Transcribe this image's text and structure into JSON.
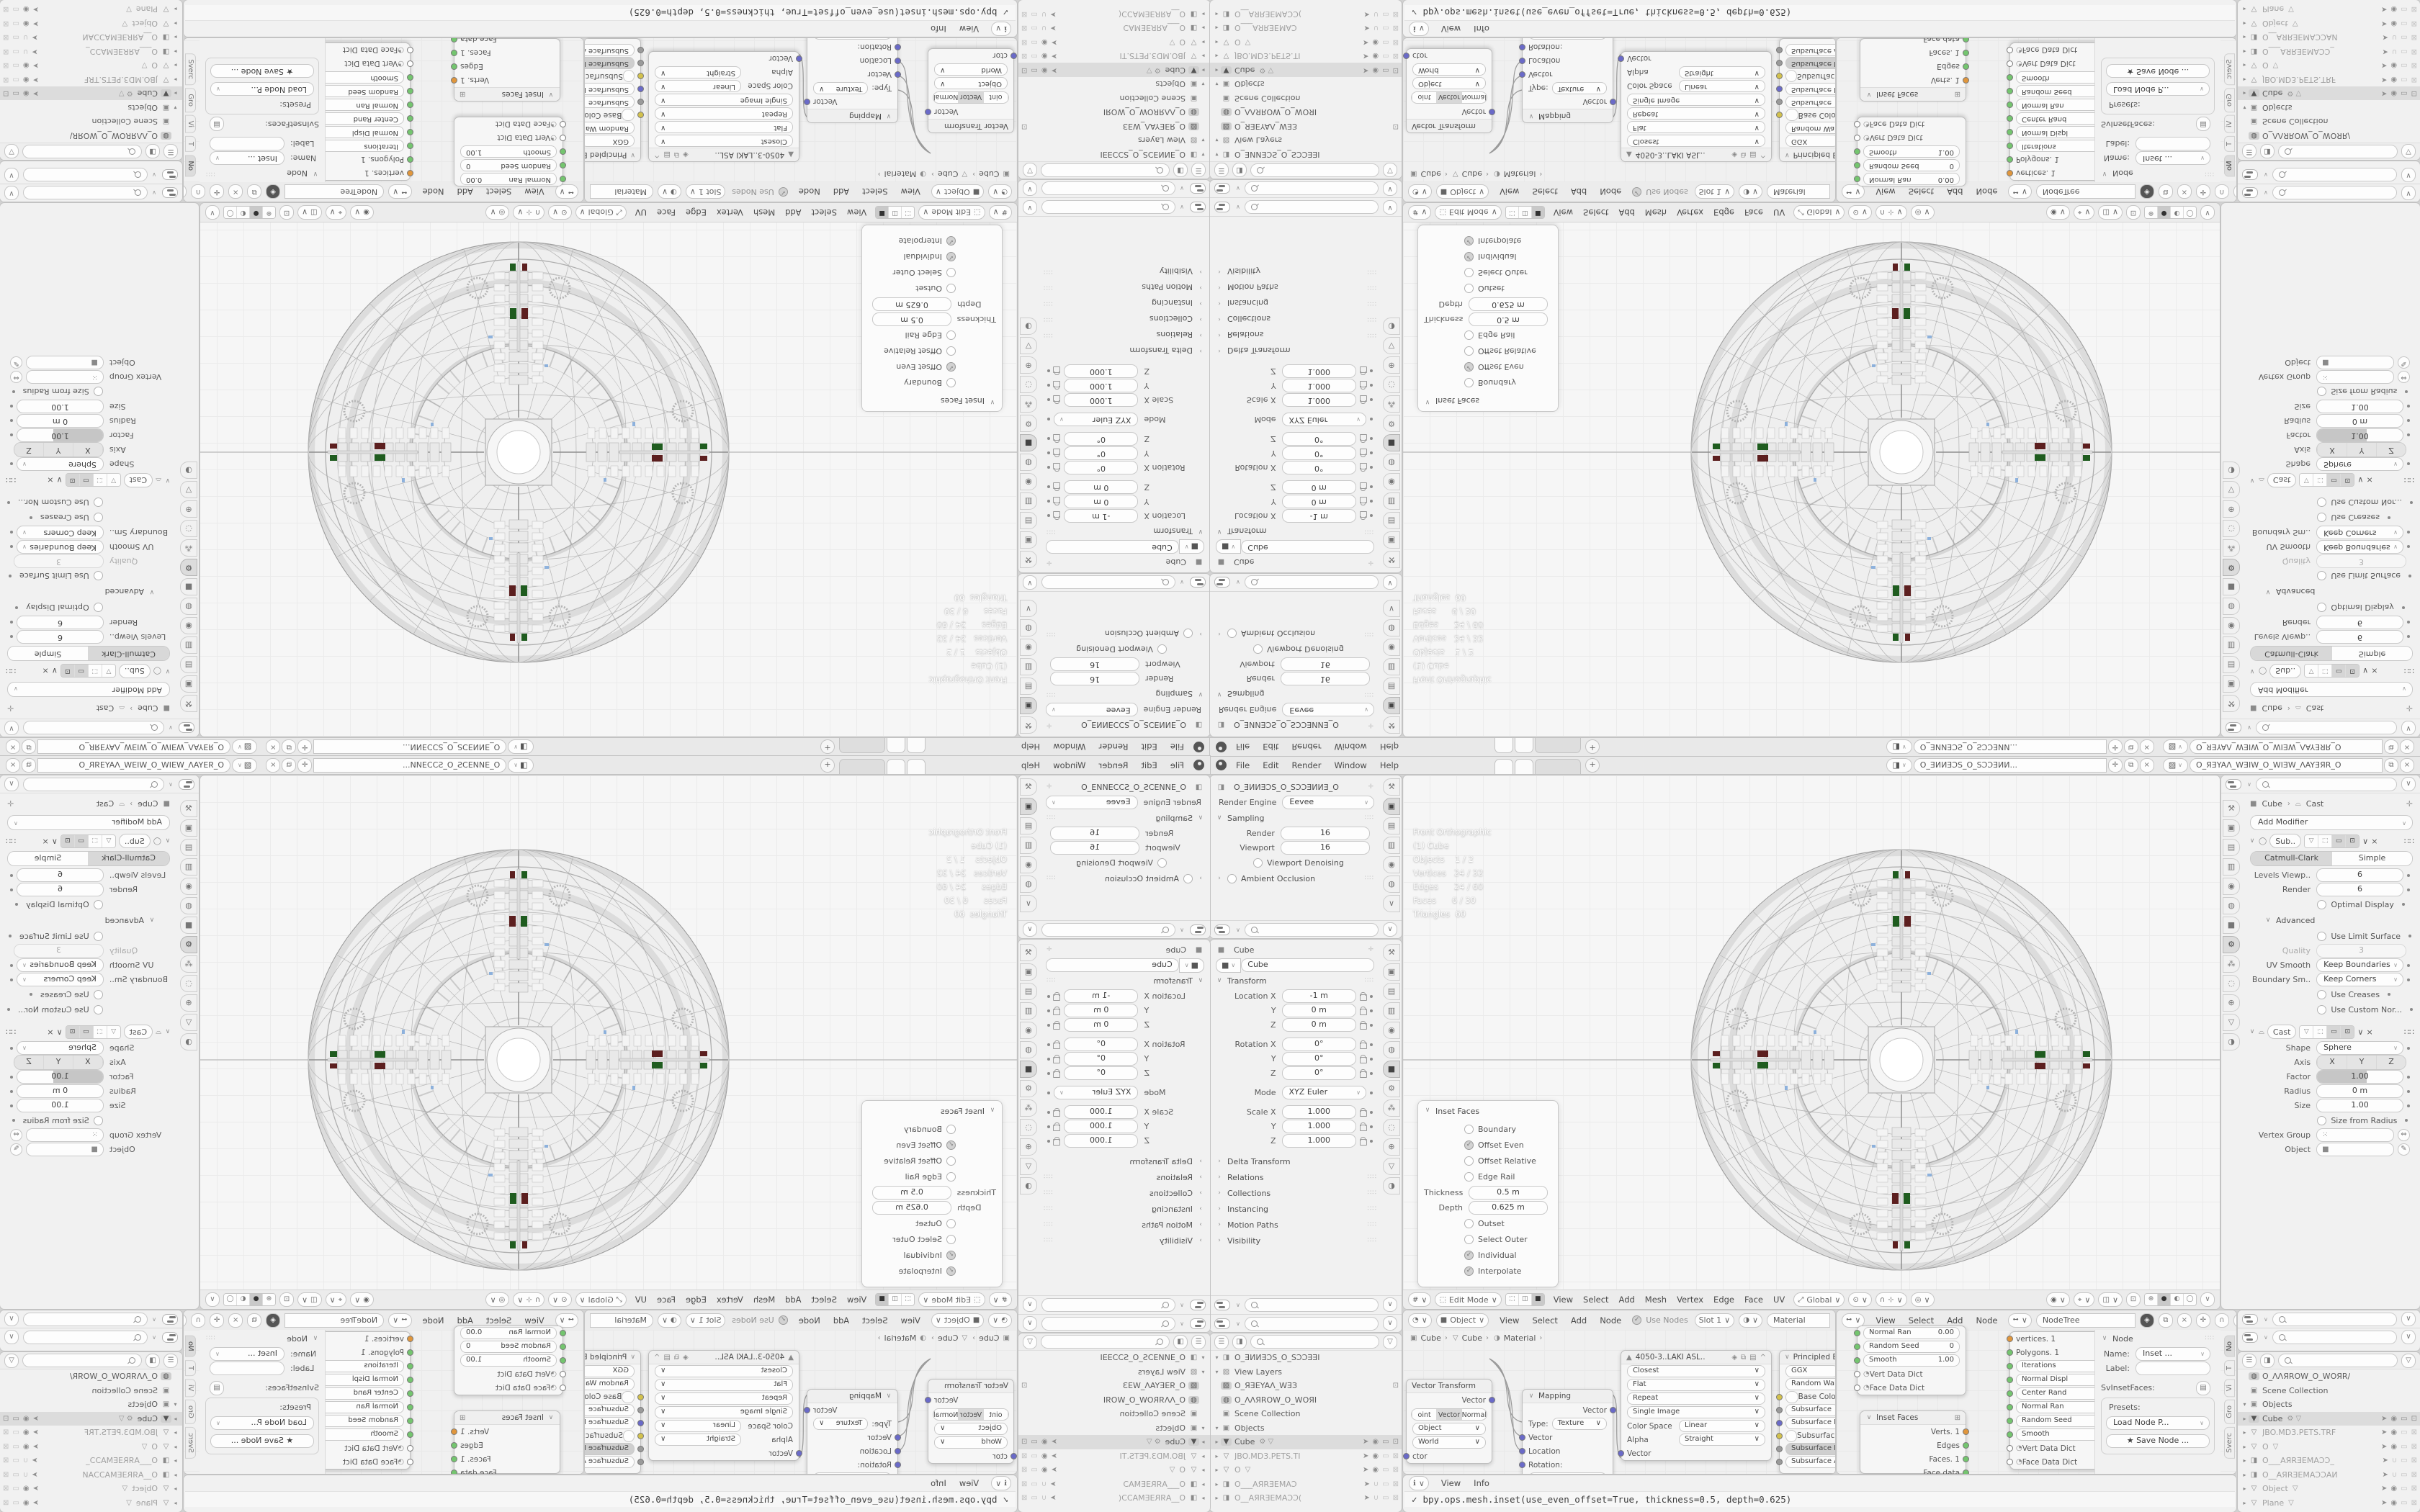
{
  "topbar": {
    "menus": [
      "File",
      "Edit",
      "Render",
      "Window",
      "Help"
    ],
    "plus": "+",
    "scene": {
      "value": "O_ƎИИƎƆS_O_SƆƆƎИИ..."
    },
    "view_layer": {
      "value": "O_ЯƎYAΛ_WƎIW_O_WIƎW_ΛAYƎЯR_O"
    }
  },
  "render_props": {
    "scene_name": "O_ƎИИƎƆS_O_SƆƆƎИИƎ_O",
    "engine_label": "Render Engine",
    "engine": "Eevee",
    "sampling_title": "Sampling",
    "rows": [
      {
        "label": "Render",
        "value": "16"
      },
      {
        "label": "Viewport",
        "value": "16"
      }
    ],
    "denoising": {
      "label": "Viewport Denoising",
      "chkcls": "chk"
    },
    "ao_label": "Ambient Occlusion"
  },
  "object_props": {
    "pin_title": "Cube",
    "name": "Cube",
    "transform_title": "Transform",
    "rows": [
      {
        "label": "Location X",
        "value": "-1 m",
        "cls": "lockdot"
      },
      {
        "label": "Y",
        "value": "0 m",
        "cls": "lockdot"
      },
      {
        "label": "Z",
        "value": "0 m",
        "cls": "lockdot"
      },
      {
        "label": "Rotation X",
        "value": "0°",
        "cls": "lockdot gap"
      },
      {
        "label": "Y",
        "value": "0°",
        "cls": "lockdot"
      },
      {
        "label": "Z",
        "value": "0°",
        "cls": "lockdot"
      },
      {
        "label": "Mode",
        "value": "XYZ Euler",
        "cls": "seldot gap"
      },
      {
        "label": "Scale X",
        "value": "1.000",
        "cls": "lockdot gap"
      },
      {
        "label": "Y",
        "value": "1.000",
        "cls": "lockdot"
      },
      {
        "label": "Z",
        "value": "1.000",
        "cls": "lockdot"
      }
    ],
    "sections": [
      {
        "label": "Delta Transform",
        "grip": ""
      },
      {
        "label": "Relations",
        "grip": "∷∷"
      },
      {
        "label": "Collections",
        "grip": "∷∷"
      },
      {
        "label": "Instancing",
        "grip": "∷∷"
      },
      {
        "label": "Motion Paths",
        "grip": "∷∷"
      },
      {
        "label": "Visibility",
        "grip": "∷∷"
      }
    ]
  },
  "outliner_left": {
    "rows": [
      {
        "disc": "▾",
        "icon": "◨",
        "name": "O_ƎИИƎƆS_O_SƆƆƎƎI",
        "ind": "i1"
      },
      {
        "disc": "▾",
        "icon": "▨",
        "name": "View Layers",
        "ind": "i2"
      },
      {
        "disc": "",
        "icon": "▨",
        "name": "O_ЯƎEYAΛ_WƎЗ",
        "ind": "i3",
        "iccls": "oic hl",
        "trailcls": "t-cam"
      },
      {
        "disc": "",
        "icon": "◍",
        "name": "O_ΛΛЯROW_O_WOЯI",
        "ind": "i2",
        "iccls": "oic hl"
      },
      {
        "disc": "",
        "icon": "▣",
        "name": "Scene Collection",
        "ind": "i2"
      },
      {
        "disc": "▾",
        "icon": "▣",
        "name": "Objects",
        "ind": "i2"
      },
      {
        "disc": "▸",
        "icon": "▼",
        "name": "Cube",
        "ind": "i3",
        "cls": "selrow",
        "iccls": "oic hl",
        "extra": "⚙ ▽",
        "trailcls": "t-full"
      },
      {
        "disc": "▸",
        "icon": "▽",
        "name": "JBO.MD3.PETS.TI",
        "ind": "i3",
        "cls": "dim",
        "trailcls": "t-std"
      },
      {
        "disc": "▸",
        "icon": "▽",
        "name": "O",
        "ind": "i3",
        "cls": "dim",
        "extra": "▽",
        "trailcls": "t-std"
      },
      {
        "disc": "▸",
        "icon": "◨",
        "name": "O___AЯRƎEMAƆ",
        "ind": "i3",
        "cls": "dim",
        "trailcls": "t-camoff"
      },
      {
        "disc": "▸",
        "icon": "◨",
        "name": "O__AЯRƎEMAƆƆ(",
        "ind": "i3",
        "cls": "dim",
        "trailcls": "t-camoff"
      }
    ]
  },
  "outliner_right": {
    "rows": [
      {
        "disc": "",
        "icon": "◍",
        "name": "O_ΛΛЯROW_O_WOЯR/",
        "ind": "i1",
        "iccls": "oic hl"
      },
      {
        "disc": "",
        "icon": "▣",
        "name": "Scene Collection",
        "ind": "i1"
      },
      {
        "disc": "▾",
        "icon": "▣",
        "name": "Objects",
        "ind": "i1"
      },
      {
        "disc": "▸",
        "icon": "▼",
        "name": "Cube",
        "ind": "i2",
        "cls": "selrow",
        "iccls": "oic hl",
        "extra": "⚙ ▽",
        "trailcls": "t-full"
      },
      {
        "disc": "▸",
        "icon": "▽",
        "name": "JBO.MD3.PETS.TRF",
        "ind": "i2",
        "cls": "dim",
        "trailcls": "t-std"
      },
      {
        "disc": "▸",
        "icon": "▽",
        "name": "O",
        "ind": "i2",
        "cls": "dim",
        "extra": "▽",
        "trailcls": "t-std"
      },
      {
        "disc": "▸",
        "icon": "◨",
        "name": "O___AЯRƎEMAƆƆ_",
        "ind": "i2",
        "cls": "dim",
        "trailcls": "t-camoff"
      },
      {
        "disc": "▸",
        "icon": "◨",
        "name": "O__AЯRƎEMAƆƆAИ",
        "ind": "i2",
        "cls": "dim",
        "trailcls": "t-camoff"
      },
      {
        "disc": "▸",
        "icon": "▽",
        "name": "Object",
        "ind": "i2",
        "cls": "dim",
        "extra": "▽",
        "trailcls": "t-std"
      },
      {
        "disc": "▸",
        "icon": "▽",
        "name": "Plane",
        "ind": "i2",
        "cls": "dim",
        "extra": "▽",
        "trailcls": "t-std"
      },
      {
        "disc": "▸",
        "icon": "▽",
        "name": "SBINEL",
        "ind": "i2",
        "cls": "dim",
        "extra": "▽",
        "trailcls": "t-std"
      }
    ]
  },
  "viewport": {
    "stats": [
      "Front Orthographic",
      "(1) Cube",
      "",
      "Objects    1 / 2",
      "Vertices   24 / 32",
      "Edges      24 / 60",
      "Faces      6 / 30",
      "Triangles  60"
    ],
    "mode": "Edit Mode",
    "menus": [
      "View",
      "Select",
      "Add",
      "Mesh",
      "Vertex",
      "Edge",
      "Face",
      "UV"
    ],
    "orientation": "Global"
  },
  "inset_panel": {
    "title": "Inset Faces",
    "checks1": [
      {
        "label": "Boundary",
        "chkcls": "chk"
      },
      {
        "label": "Offset Even",
        "chkcls": "chk on"
      },
      {
        "label": "Offset Relative",
        "chkcls": "chk"
      },
      {
        "label": "Edge Rail",
        "chkcls": "chk"
      }
    ],
    "rows": [
      {
        "label": "Thickness",
        "value": "0.5 m"
      },
      {
        "label": "Depth",
        "value": "0.625 m"
      }
    ],
    "checks2": [
      {
        "label": "Outset",
        "chkcls": "chk"
      },
      {
        "label": "Select Outer",
        "chkcls": "chk"
      },
      {
        "label": "Individual",
        "chkcls": "chk on"
      },
      {
        "label": "Interpolate",
        "chkcls": "chk on"
      }
    ]
  },
  "modifier_props": {
    "breadcrumb_object": "Cube",
    "breadcrumb_modifier": "Cast",
    "add_label": "Add Modifier",
    "subdiv": {
      "name": "Sub..",
      "seg": [
        {
          "label": "Catmull-Clark",
          "cls": "act"
        },
        {
          "label": "Simple"
        }
      ],
      "rows": [
        {
          "label": "Levels Viewp..",
          "value": "6",
          "cls": "dotonly"
        },
        {
          "label": "Render",
          "value": "6",
          "cls": "dotonly"
        }
      ],
      "optimal": {
        "label": "Optimal Display",
        "chkcls": "chk"
      },
      "advanced_title": "Advanced",
      "limit": {
        "label": "Use Limit Surface",
        "chkcls": "chk"
      },
      "quality": {
        "label": "Quality",
        "value": "3"
      },
      "selrows": [
        {
          "label": "UV Smooth",
          "value": "Keep Boundaries"
        },
        {
          "label": "Boundary Sm..",
          "value": "Keep Corners"
        }
      ],
      "creases": {
        "label": "Use Creases",
        "chkcls": "chk"
      },
      "custom": {
        "label": "Use Custom Nor...",
        "chkcls": "chk"
      }
    },
    "cast": {
      "name": "Cast",
      "shape_label": "Shape",
      "shape": "Sphere",
      "axis_label": "Axis",
      "axis": [
        {
          "label": "X",
          "cls": "act"
        },
        {
          "label": "Y",
          "cls": "act"
        },
        {
          "label": "Z",
          "cls": "act"
        }
      ],
      "factor": {
        "label": "Factor",
        "value": "1.00"
      },
      "rows": [
        {
          "label": "Radius",
          "value": "0 m",
          "cls": "dotonly"
        },
        {
          "label": "Size",
          "value": "1.00",
          "cls": "dotonly"
        }
      ],
      "sfr": {
        "label": "Size from Radius",
        "chkcls": "chk"
      },
      "vgroup_label": "Vertex Group",
      "object_label": "Object"
    }
  },
  "shader": {
    "obj_mode": "Object",
    "menus": [
      "View",
      "Select",
      "Add",
      "Node"
    ],
    "use_nodes": "Use Nodes",
    "slot": "Slot 1",
    "material": "Material",
    "breadcrumb": [
      {
        "icon": "▣",
        "name": "Cube"
      },
      {
        "icon": "▽",
        "name": "Cube"
      },
      {
        "icon": "◑",
        "name": "Material"
      }
    ],
    "vt": {
      "title": "Vector Transform",
      "out": "Vector",
      "seg": [
        {
          "label": "oint"
        },
        {
          "label": "Vector",
          "cls": "act"
        },
        {
          "label": "Normal"
        }
      ],
      "selects": [
        {
          "value": "Object"
        },
        {
          "value": "World"
        }
      ],
      "in_label": "ctor"
    },
    "mapping": {
      "title": "Mapping",
      "out": "Vector",
      "type_label": "Type:",
      "type": "Texture",
      "ins": [
        {
          "label": "Vector"
        },
        {
          "label": "Location"
        },
        {
          "label": "Rotation:"
        }
      ],
      "x_label": "X",
      "x_value": "0°"
    },
    "tex": {
      "name": "4050-3..LAKI ASL..",
      "selects": [
        {
          "value": "Closest"
        },
        {
          "value": "Flat"
        },
        {
          "value": "Repeat"
        },
        {
          "value": "Single Image"
        }
      ],
      "cs_label": "Color Space",
      "cs": "Linear",
      "alpha_label": "Alpha",
      "alpha": "Straight",
      "in_label": "Vector"
    },
    "bsdf": {
      "title": "Principled BSDF",
      "rows": [
        {
          "value": "GGX"
        },
        {
          "value": "Random Walk"
        },
        {
          "label": "Base Color",
          "scls": "sock L sy"
        },
        {
          "value": "Subsurface",
          "scls": "sock L sgr"
        },
        {
          "value": "Subsurface Radiu",
          "scls": "sock L sp"
        },
        {
          "label": "Subsurface Color",
          "scls": "sock L sy"
        },
        {
          "value": "Subsurface IOR",
          "scls": "sock L sgr",
          "cls": "issel"
        },
        {
          "value": "Subsurface Anis",
          "scls": "sock L sgr"
        }
      ]
    }
  },
  "nodetree": {
    "menus": [
      "View",
      "Select",
      "Add",
      "Node"
    ],
    "name": "NodeTree",
    "upper": {
      "params": [
        {
          "label": "Normal Ran",
          "value": "0.00"
        },
        {
          "label": "Random Seed",
          "value": "0"
        },
        {
          "label": "Smooth",
          "value": "1.00"
        }
      ],
      "dicts": [
        {
          "label": "Vert Data Dict"
        },
        {
          "label": "Face Data Dict"
        }
      ]
    },
    "inset_node": {
      "title": "Inset Faces",
      "outs": [
        {
          "label": "Verts. 1",
          "scls": "sock R so"
        },
        {
          "label": "Edges",
          "scls": "sock R sg"
        },
        {
          "label": "Faces. 1",
          "scls": "sock R sg"
        },
        {
          "label": "Face data",
          "scls": "sock R sg"
        }
      ]
    },
    "param_node": {
      "tops": [
        {
          "label": "vertices. 1",
          "scls": "sock L so"
        },
        {
          "label": "Polygons. 1",
          "scls": "sock L sg"
        }
      ],
      "fields": [
        {
          "label": "Iterations",
          "value": "3"
        },
        {
          "label": "Normal Displ",
          "value": "0.00"
        },
        {
          "label": "Center Rand",
          "value": "0.00"
        },
        {
          "label": "Normal Ran",
          "value": "0.00"
        },
        {
          "label": "Random Seed",
          "value": "0"
        },
        {
          "label": "Smooth",
          "value": "1.00"
        }
      ],
      "dicts": [
        {
          "label": "Vert Data Dict"
        },
        {
          "label": "Face Data Dict"
        }
      ]
    },
    "npanel": {
      "title": "Node",
      "name_label": "Name:",
      "name_value": "Inset ...",
      "label_label": "Label:",
      "class_label": "SvInsetFaces:",
      "presets_label": "Presets:",
      "load_label": "Load Node P...",
      "save_label": "Save Node ..."
    },
    "tabs": [
      {
        "label": "No",
        "cls": "act"
      },
      {
        "label": "T"
      },
      {
        "label": "Vi"
      },
      {
        "label": "Gro"
      },
      {
        "label": "Sverc"
      }
    ]
  },
  "info": {
    "menus": [
      "View",
      "Info"
    ],
    "check": "✓",
    "log": "bpy.ops.mesh.inset(use_even_offset=True, thickness=0.5, depth=0.625)"
  },
  "icon_strips": {
    "strip_a": [
      {
        "g": "⚒"
      },
      {
        "g": "▣",
        "cls": "act"
      },
      {
        "g": "▤"
      },
      {
        "g": "▥"
      },
      {
        "g": "◉"
      },
      {
        "g": "◍"
      },
      {
        "g": "∨"
      }
    ],
    "strip_b": [
      {
        "g": "⚒"
      },
      {
        "g": "▣"
      },
      {
        "g": "▤"
      },
      {
        "g": "▥"
      },
      {
        "g": "◉"
      },
      {
        "g": "◍"
      },
      {
        "g": "■",
        "cls": "act"
      },
      {
        "g": "⚙"
      },
      {
        "g": "⁂"
      },
      {
        "g": "◌"
      },
      {
        "g": "⊕"
      },
      {
        "g": "▽"
      },
      {
        "g": "◑"
      }
    ],
    "strip_mod": [
      {
        "g": "⚒"
      },
      {
        "g": "▣"
      },
      {
        "g": "▤"
      },
      {
        "g": "▥"
      },
      {
        "g": "◉"
      },
      {
        "g": "◍"
      },
      {
        "g": "■"
      },
      {
        "g": "⚙",
        "cls": "act"
      },
      {
        "g": "⁂"
      },
      {
        "g": "◌"
      },
      {
        "g": "⊕"
      },
      {
        "g": "▽"
      },
      {
        "g": "◑"
      }
    ]
  },
  "colors": {
    "accent": "#4772b3",
    "socket_green": "#74c56f",
    "socket_orange": "#e0963c",
    "socket_purple": "#6a6ac8",
    "socket_yellow": "#d2c14d",
    "wire": "#9a9a9a",
    "detail_green": "#1f5c1f",
    "detail_red": "#5c1f1f",
    "speck_blue": "#7da7d9"
  }
}
